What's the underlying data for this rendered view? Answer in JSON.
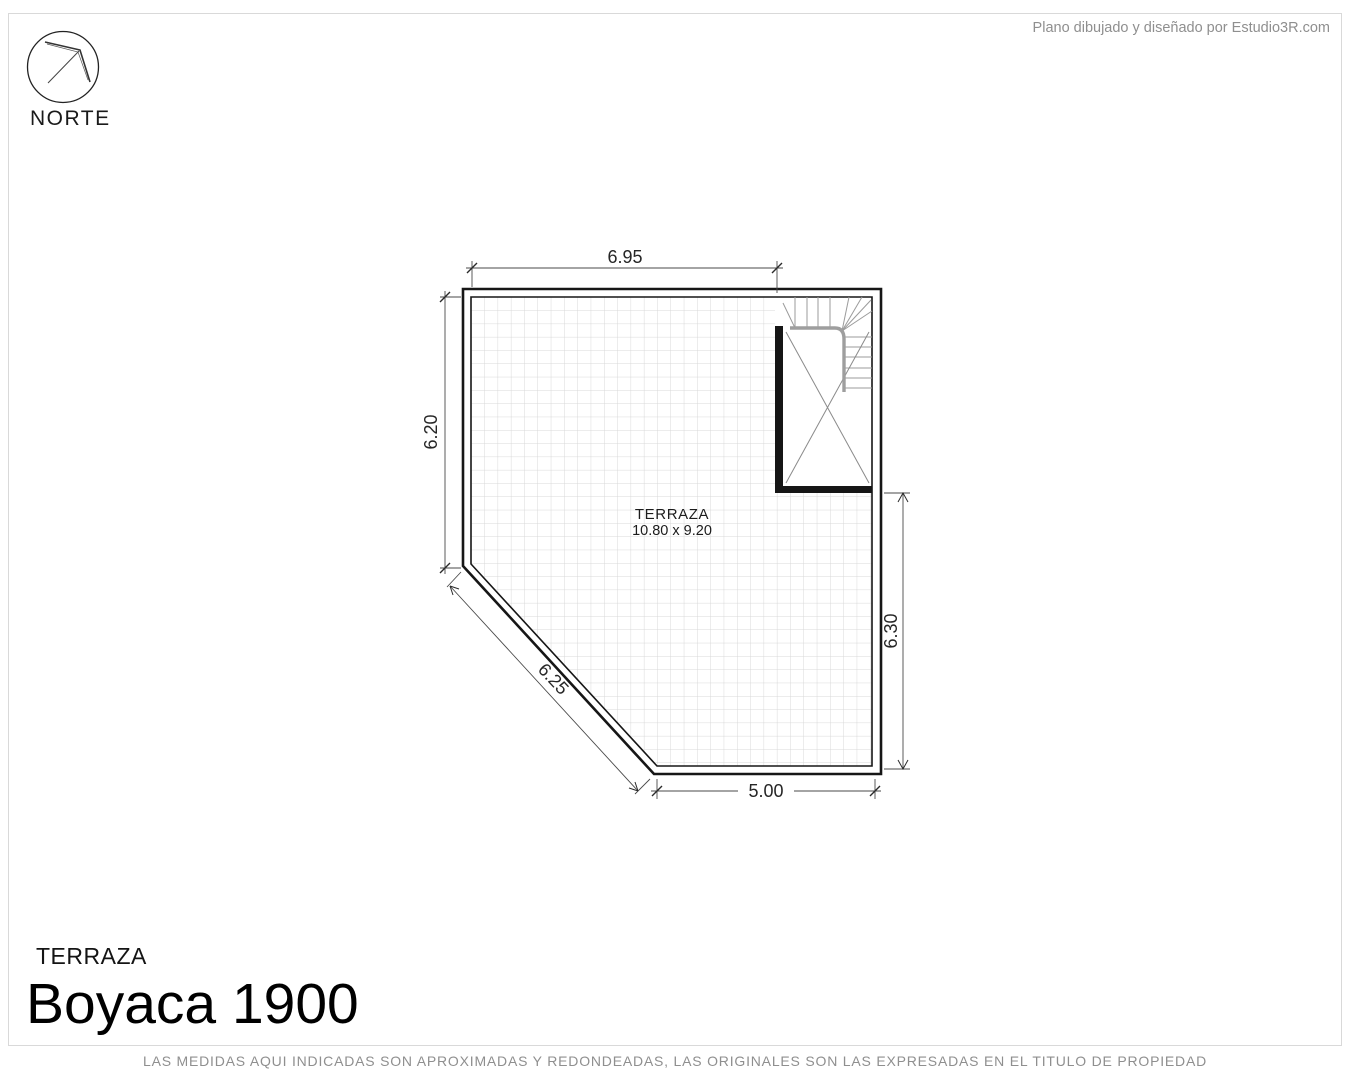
{
  "header": {
    "credit": "Plano dibujado y diseñado por Estudio3R.com"
  },
  "compass": {
    "label": "NORTE"
  },
  "plan": {
    "room_label": "TERRAZA",
    "room_size": "10.80 x 9.20",
    "dimensions": {
      "top": "6.95",
      "left": "6.20",
      "right": "6.30",
      "bottom": "5.00",
      "diagonal": "6.25"
    }
  },
  "footer": {
    "floor_label": "TERRAZA",
    "project_title": "Boyaca 1900",
    "disclaimer": "LAS MEDIDAS AQUI INDICADAS SON APROXIMADAS Y REDONDEADAS, LAS ORIGINALES SON LAS EXPRESADAS EN EL TITULO DE PROPIEDAD"
  },
  "colors": {
    "wall": "#161616",
    "dimension_line": "#4a4a4a",
    "tile_grid": "#d8d8d8",
    "muted_text": "#8f8f8f",
    "handrail": "#9e9e9e"
  }
}
